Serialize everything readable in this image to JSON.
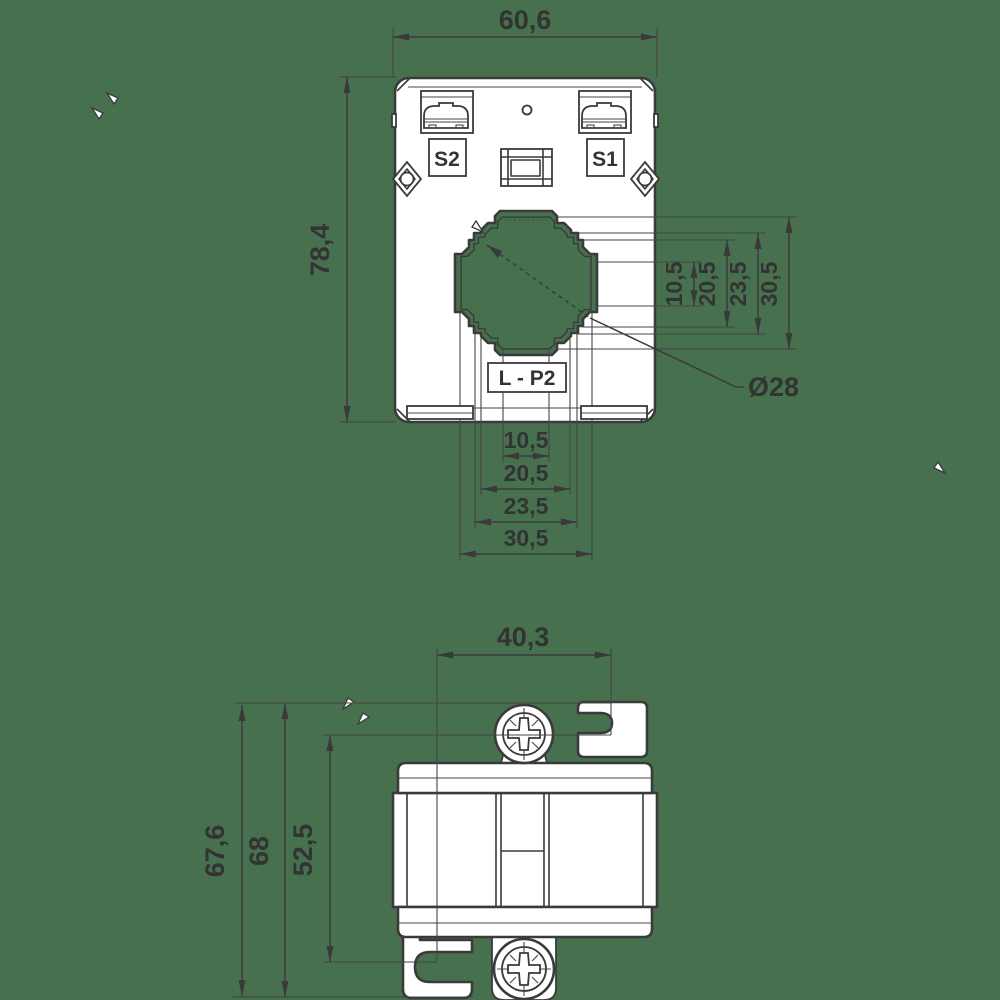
{
  "drawing": {
    "type": "dimensional technical drawing of a current transformer",
    "background_color": "#47704e",
    "line_color": "#3a3a3a",
    "body_fill": "#ffffff"
  },
  "front_view": {
    "width": "60,6",
    "height": "78,4",
    "terminal_s2": "S2",
    "terminal_s1": "S1",
    "winding_label": "L - P2",
    "hole_diameter": "Ø28",
    "h_chain": [
      "10,5",
      "20,5",
      "23,5",
      "30,5"
    ],
    "v_chain": [
      "10,5",
      "20,5",
      "23,5",
      "30,5"
    ]
  },
  "side_view": {
    "width": "40,3",
    "height_outer": "67,6",
    "height_total": "68",
    "height_clip": "52,5"
  }
}
